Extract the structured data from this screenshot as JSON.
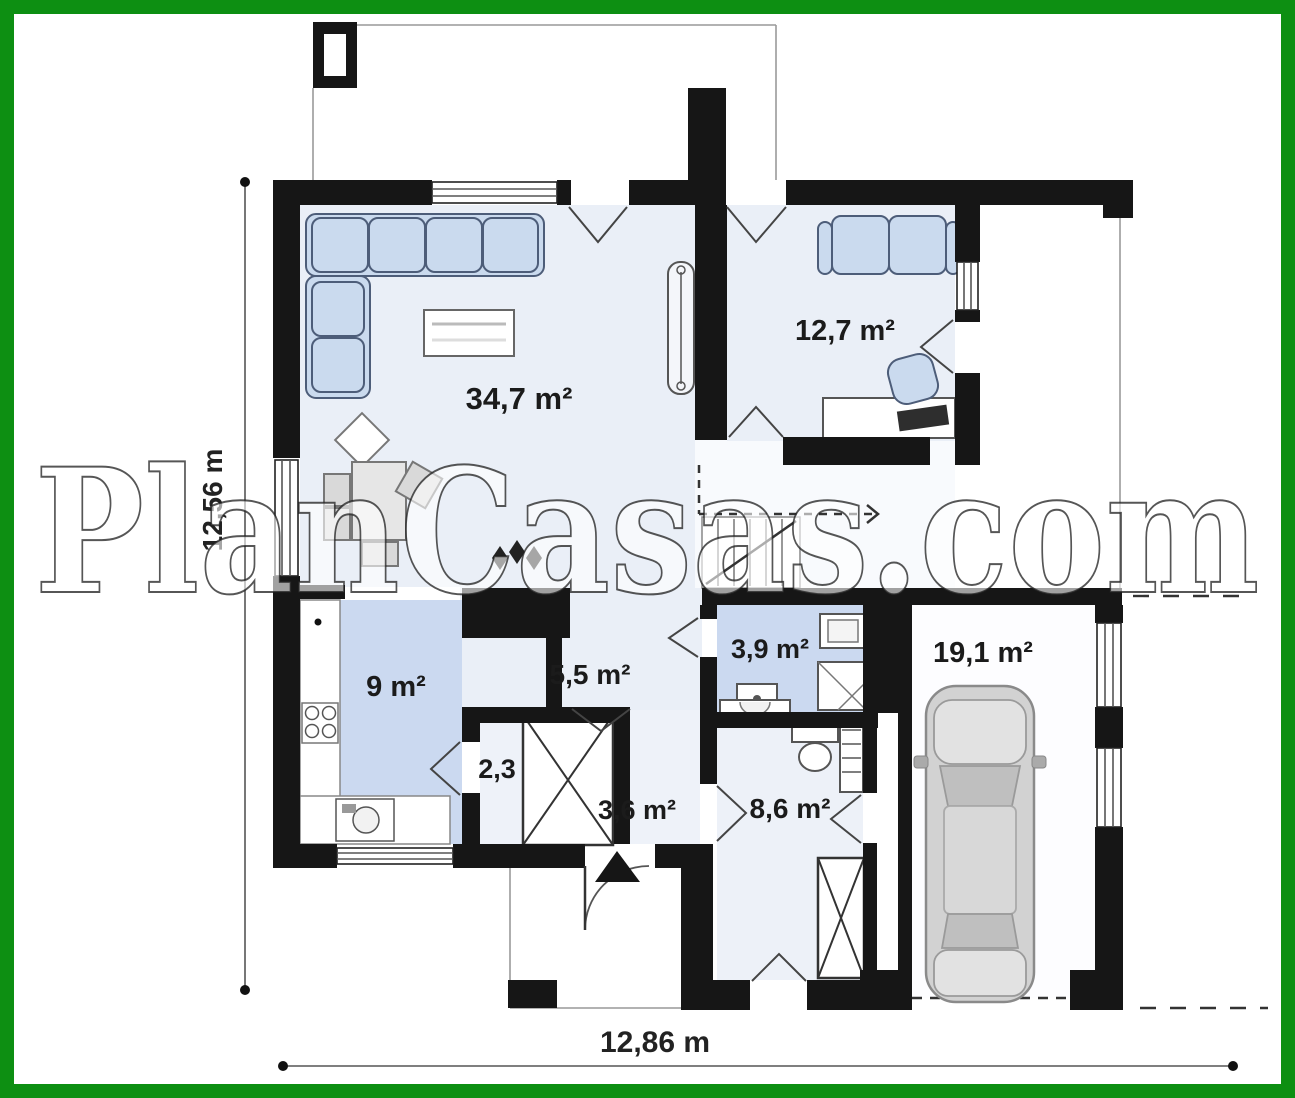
{
  "watermark": "PlanCasas.com",
  "dimensions": {
    "height_label": "12,56 m",
    "width_label": "12,86 m"
  },
  "rooms": {
    "living": "34,7 m²",
    "bedroom": "12,7 m²",
    "kitchen": "9 m²",
    "hall": "5,5 m²",
    "bathroom": "3,9 m²",
    "closet": "2,3",
    "entry": "3,6 m²",
    "utility": "8,6 m²",
    "garage": "19,1 m²"
  },
  "colors": {
    "frame_green": "#0d8f12",
    "wall_black": "#161616",
    "floor_light": "#eaeff7",
    "floor_blue": "#cbd9f0",
    "furniture_blue": "#cadaee",
    "car_gray": "#d2d2d2"
  }
}
